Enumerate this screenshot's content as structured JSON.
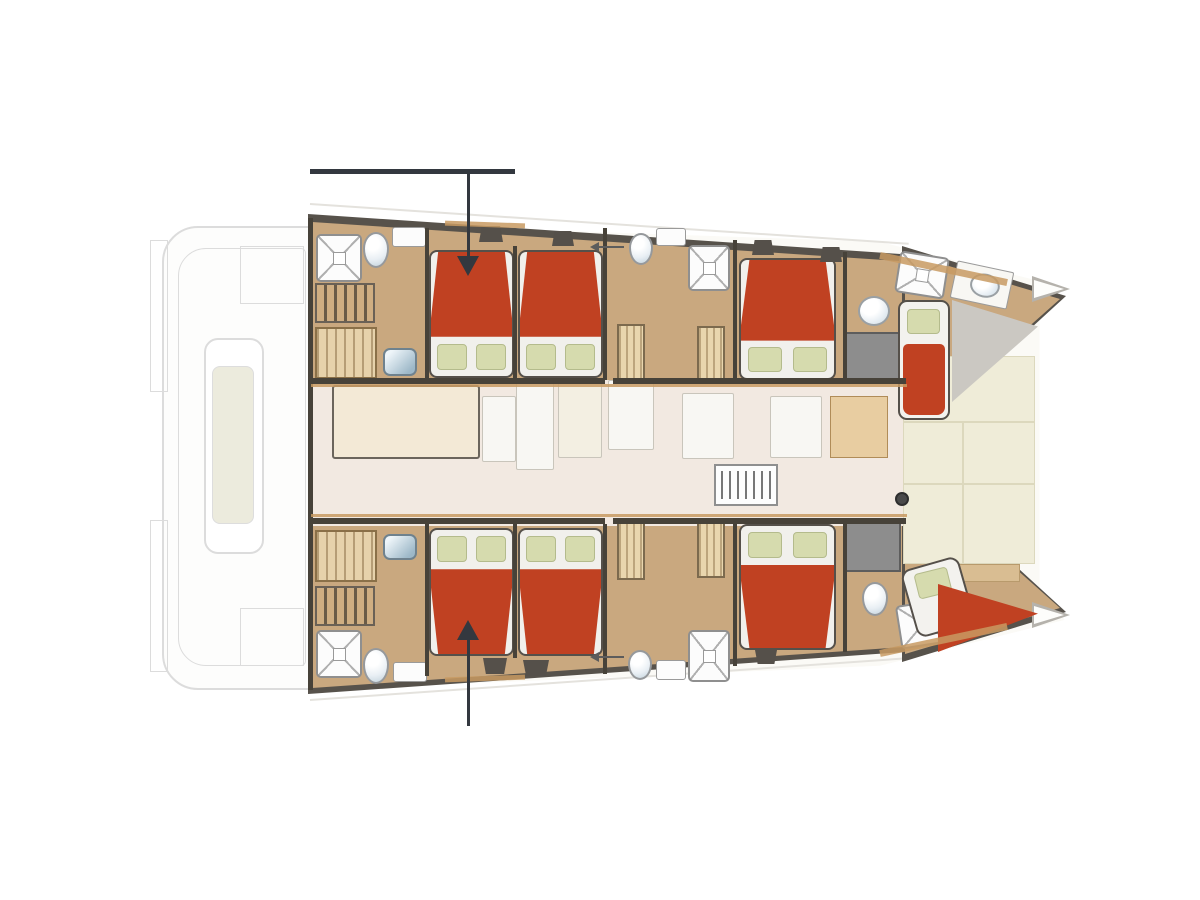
{
  "document": {
    "type": "yacht-floor-plan",
    "subject": "sailing catamaran accommodation deck plan, bow facing right",
    "visible_text": ""
  },
  "colors": {
    "wall": "#474239",
    "hull_edge": "#57524b",
    "bed_red": "#c04122",
    "pillow": "#d6dbae",
    "pillow_border": "#b4bb8c",
    "hull_floor": "#c9a87f",
    "salon_floor": "#f2e9e1",
    "table_wood": "#f3e9d6",
    "cream_deck": "#efecd8",
    "locker_gray": "#8d8d8d",
    "wedge_gray": "#cbc8c2",
    "white_fixture": "#fcfcfc",
    "porcelain_blue": "#bfd0da",
    "basin_blue": "#9db8c8",
    "wood_trim": "#c89a62",
    "stairs_light": "#cfae82",
    "stairs_dark": "#6a5b47",
    "wardrobe_bg": "#e6d2ab",
    "cabinet_wood": "#e8cda1",
    "annotation": "#33383f",
    "ghost_line": "#dcdcdc",
    "ghost_fill": "#fdfdfc",
    "seat_cream": "#ecebdd",
    "sofa_white": "#f8f7f3",
    "deck_white": "#fbfaf6"
  },
  "fixture_inventory": {
    "double_beds": 6,
    "single_berths": 2,
    "showers": 6,
    "toilets": 5,
    "wash_basins": 6,
    "stairways": 2,
    "wardrobes": 6,
    "galley_stove": 1,
    "salon_table": 1,
    "cockpit_bench": 1
  },
  "annotations": {
    "reference_line_top": 1,
    "callout_arrow_down": 1,
    "callout_arrow_up": 1,
    "door_swing_arrows": 2
  }
}
